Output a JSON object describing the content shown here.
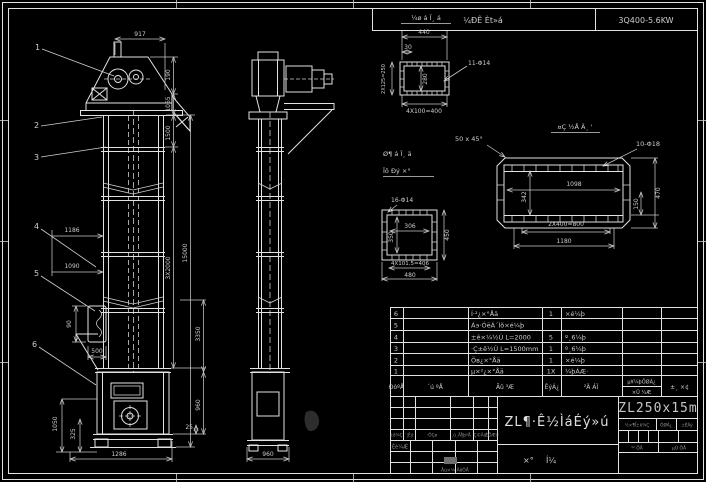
{
  "header": {
    "left": "¼ÐÊ Èt»á",
    "right": "3Q400-5.6KW"
  },
  "front_view": {
    "balloons": [
      "1",
      "2",
      "3",
      "4",
      "5",
      "6"
    ],
    "dim_917": "917",
    "dim_190": "190",
    "dim_1065": "1065",
    "dim_1500": "1500",
    "dim_3x2000": "3X2000",
    "dim_15000": "15000",
    "dim_3350": "3350",
    "dim_1186": "1186",
    "dim_1090": "1090",
    "dim_90": "90",
    "dim_500": "500",
    "dim_1050": "1050",
    "dim_325": "325",
    "dim_1286": "1286",
    "dim_25": "25",
    "dim_960": "960"
  },
  "side_view": {
    "dim_960": "960"
  },
  "flange_detail": {
    "title": "¼ø á Ï¸ á",
    "dim_440": "440",
    "dim_30": "30",
    "dim_left": "2X125=250",
    "dim_inner": "280",
    "dim_bottom": "4X100=400",
    "leader": "11-Φ14"
  },
  "mid_detail": {
    "title_line1": "Ø¶ á Ï¸ ä",
    "title_line2": "Ïô Ðý ×°",
    "leader": "16-Φ14",
    "dim_w": "306",
    "dim_h": "350",
    "dim_right": "450",
    "dim_bottom": "4X101.5=406",
    "dim_overall": "480"
  },
  "big_detail": {
    "title": "¤Ç ½Å Ä¸ '",
    "chamfer": "50 x 45°",
    "leader": "10-Φ18",
    "dim_1098": "1098",
    "dim_342": "342",
    "dim_150": "150",
    "dim_470": "470",
    "dim_800": "2X400=800",
    "dim_1180": "1180"
  },
  "parts_table": {
    "headers": {
      "no": "ÐòºÅ",
      "code": "´ú ºÅ",
      "name": "Ãû ³Æ",
      "qty": "ÊýÁ¿",
      "mat": "²Ä ÁÏ",
      "weight_top": "µ¥¼þÖØÁ¿",
      "weight_bot": "×Ü ¼Æ",
      "remark": "±¸ ×¢"
    },
    "rows": [
      {
        "no": "6",
        "code": "",
        "name": "Í·²¿×°Åä",
        "qty": "1",
        "mat": "×é¼þ"
      },
      {
        "no": "5",
        "code": "",
        "name": "Á϶·ÓëÁ´Ìõ×é¼þ",
        "qty": "",
        "mat": ""
      },
      {
        "no": "4",
        "code": "",
        "name": "±ê×¼½Ú L=2000",
        "qty": "5",
        "mat": "º¸6¼þ"
      },
      {
        "no": "3",
        "code": "",
        "name": "·Ç±ê½Ú L=1500mm",
        "qty": "1",
        "mat": "º¸6¼þ"
      },
      {
        "no": "2",
        "code": "",
        "name": "Öв¿×°Åä",
        "qty": "1",
        "mat": "×é¼þ"
      },
      {
        "no": "1",
        "code": "",
        "name": "µ×²¿×°Åä",
        "qty": "1X",
        "mat": "¼þÁÆ·"
      }
    ]
  },
  "title_block": {
    "revision_cells": [
      "±ê¼Ç",
      "´¦Êý",
      "·ÖÇø",
      "¸ü¸ÄÎļþºÅ",
      "Ç©Ãû",
      "ÈÕÆÚ"
    ],
    "design": "Éè¼Æ",
    "approve": "Åú×¼ ÄêÔÂ",
    "main_title": "ZL¶·Ê½ÌáÉý»ú",
    "type_char1": "×°",
    "type_char2": "Í¼",
    "model": "ZL250x15m",
    "stage": "½×¶Î±ê¼Ç",
    "weight": "ÖØÁ¿",
    "scale": "±ÈÀý",
    "sheet_total": "¹² ÕÅ",
    "sheet_no": "µÚ ÕÅ"
  }
}
